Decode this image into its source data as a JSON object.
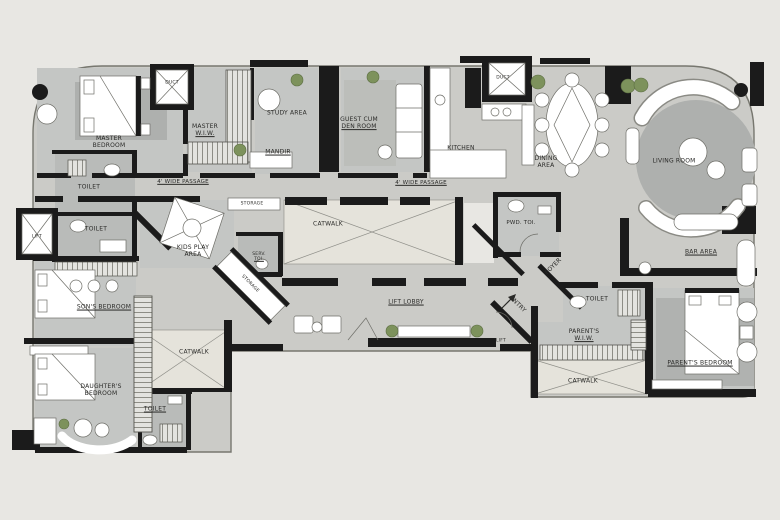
{
  "document": {
    "type": "residential-floor-plan"
  },
  "colors": {
    "bg": "#e8e7e3",
    "wall": "#1b1b1b",
    "floor": "#cbcbc7",
    "room": "#c4c6c4",
    "room_dark": "#b9bbb9",
    "rug": "#aeb0ae",
    "catwalk": "#e5e3db",
    "plant": "#7d925c",
    "ink": "#2a2a28"
  },
  "plan": {
    "labels": [
      {
        "id": "duct-left",
        "lines": [
          "DUCT"
        ],
        "x": 172,
        "y": 83,
        "rot": 0,
        "u": false,
        "s": 4.5
      },
      {
        "id": "master-bedroom",
        "lines": [
          "MASTER",
          "BEDROOM"
        ],
        "x": 109,
        "y": 143,
        "rot": 0,
        "u": false,
        "s": 6
      },
      {
        "id": "master-wiw",
        "lines": [
          "MASTER",
          "W.I.W."
        ],
        "x": 205,
        "y": 131,
        "rot": 0,
        "u": true,
        "s": 6
      },
      {
        "id": "study-area",
        "lines": [
          "STUDY AREA"
        ],
        "x": 287,
        "y": 114,
        "rot": 0,
        "u": false,
        "s": 6
      },
      {
        "id": "mandir",
        "lines": [
          "MANDIR"
        ],
        "x": 278,
        "y": 153,
        "rot": 0,
        "u": true,
        "s": 6
      },
      {
        "id": "guest-cum-den-room",
        "lines": [
          "GUEST CUM",
          "DEN ROOM"
        ],
        "x": 359,
        "y": 124,
        "rot": 0,
        "u": true,
        "s": 6
      },
      {
        "id": "kitchen",
        "lines": [
          "KITCHEN"
        ],
        "x": 461,
        "y": 149,
        "rot": 0,
        "u": false,
        "s": 6
      },
      {
        "id": "duct-top",
        "lines": [
          "DUCT"
        ],
        "x": 503,
        "y": 78,
        "rot": 0,
        "u": false,
        "s": 4.5
      },
      {
        "id": "dining-area",
        "lines": [
          "DINING",
          "AREA"
        ],
        "x": 546,
        "y": 163,
        "rot": 0,
        "u": false,
        "s": 6
      },
      {
        "id": "living-room",
        "lines": [
          "LIVING ROOM"
        ],
        "x": 674,
        "y": 162,
        "rot": 0,
        "u": false,
        "s": 6
      },
      {
        "id": "passage-left",
        "lines": [
          "4' WIDE PASSAGE"
        ],
        "x": 183,
        "y": 182,
        "rot": 0,
        "u": true,
        "s": 5.5
      },
      {
        "id": "passage-right",
        "lines": [
          "4' WIDE PASSAGE"
        ],
        "x": 421,
        "y": 183,
        "rot": 0,
        "u": true,
        "s": 5.5
      },
      {
        "id": "toilet-master-1",
        "lines": [
          "TOILET"
        ],
        "x": 89,
        "y": 188,
        "rot": 0,
        "u": false,
        "s": 6
      },
      {
        "id": "toilet-master-2",
        "lines": [
          "TOILET"
        ],
        "x": 96,
        "y": 230,
        "rot": 0,
        "u": false,
        "s": 6
      },
      {
        "id": "lift-left",
        "lines": [
          "LIFT"
        ],
        "x": 37,
        "y": 237,
        "rot": 0,
        "u": false,
        "s": 4.5
      },
      {
        "id": "storage-top",
        "lines": [
          "STORAGE"
        ],
        "x": 252,
        "y": 204,
        "rot": 0,
        "u": false,
        "s": 4.5
      },
      {
        "id": "catwalk-mid",
        "lines": [
          "CATWALK"
        ],
        "x": 328,
        "y": 225,
        "rot": 0,
        "u": false,
        "s": 6
      },
      {
        "id": "kids-play-area",
        "lines": [
          "KIDS PLAY",
          "AREA"
        ],
        "x": 193,
        "y": 252,
        "rot": 0,
        "u": false,
        "s": 6
      },
      {
        "id": "serv-toi",
        "lines": [
          "SERV.",
          "TOI."
        ],
        "x": 259,
        "y": 257,
        "rot": 0,
        "u": true,
        "s": 4.5
      },
      {
        "id": "storage-diagonal",
        "lines": [
          "STORAGE"
        ],
        "x": 250,
        "y": 284,
        "rot": 45,
        "u": false,
        "s": 4.5
      },
      {
        "id": "lift-lobby",
        "lines": [
          "LIFT LOBBY"
        ],
        "x": 406,
        "y": 303,
        "rot": 0,
        "u": true,
        "s": 6
      },
      {
        "id": "lift-right",
        "lines": [
          "LIFT"
        ],
        "x": 501,
        "y": 341,
        "rot": 0,
        "u": false,
        "s": 4.5
      },
      {
        "id": "pwd-toi",
        "lines": [
          "PWD. TOI."
        ],
        "x": 521,
        "y": 223,
        "rot": 0,
        "u": false,
        "s": 5.5
      },
      {
        "id": "foyer",
        "lines": [
          "FOYER"
        ],
        "x": 554,
        "y": 267,
        "rot": -45,
        "u": false,
        "s": 6
      },
      {
        "id": "entry",
        "lines": [
          "ENTRY"
        ],
        "x": 517,
        "y": 305,
        "rot": 45,
        "u": false,
        "s": 6
      },
      {
        "id": "toilet-parents",
        "lines": [
          "TOILET"
        ],
        "x": 597,
        "y": 300,
        "rot": 0,
        "u": false,
        "s": 6
      },
      {
        "id": "parents-wiw",
        "lines": [
          "PARENT'S",
          "W.I.W."
        ],
        "x": 584,
        "y": 336,
        "rot": 0,
        "u": true,
        "s": 6
      },
      {
        "id": "parents-bedroom",
        "lines": [
          "PARENT'S BEDROOM"
        ],
        "x": 700,
        "y": 364,
        "rot": 0,
        "u": true,
        "s": 6
      },
      {
        "id": "catwalk-bottom-right",
        "lines": [
          "CATWALK"
        ],
        "x": 583,
        "y": 382,
        "rot": 0,
        "u": false,
        "s": 6
      },
      {
        "id": "bar-area",
        "lines": [
          "BAR AREA"
        ],
        "x": 701,
        "y": 253,
        "rot": 0,
        "u": true,
        "s": 6
      },
      {
        "id": "sons-bedroom",
        "lines": [
          "SON'S BEDROOM"
        ],
        "x": 104,
        "y": 308,
        "rot": 0,
        "u": true,
        "s": 6
      },
      {
        "id": "daughters-bedroom",
        "lines": [
          "DAUGHTER'S",
          "BEDROOM"
        ],
        "x": 101,
        "y": 391,
        "rot": 0,
        "u": false,
        "s": 6
      },
      {
        "id": "toilet-daughters",
        "lines": [
          "TOILET"
        ],
        "x": 155,
        "y": 410,
        "rot": 0,
        "u": true,
        "s": 6
      },
      {
        "id": "catwalk-bottom-left",
        "lines": [
          "CATWALK"
        ],
        "x": 194,
        "y": 353,
        "rot": 0,
        "u": false,
        "s": 6
      }
    ]
  }
}
